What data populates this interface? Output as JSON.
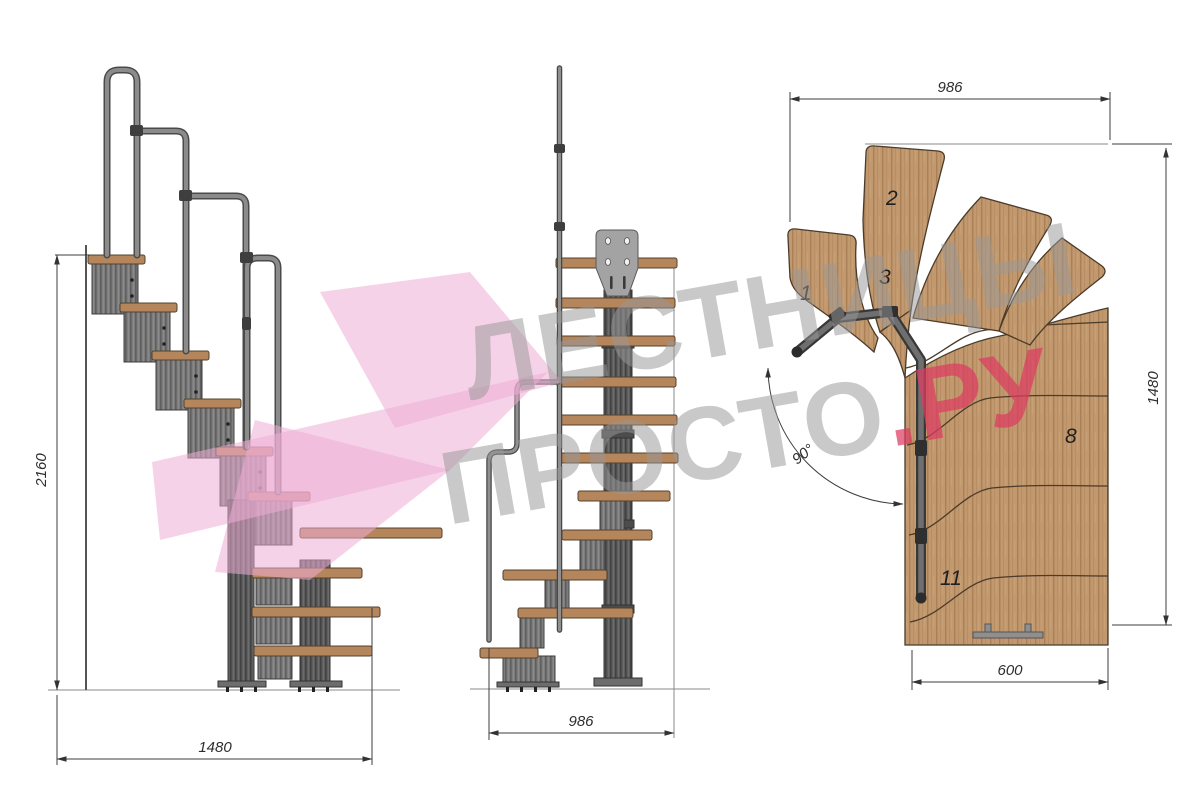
{
  "watermark": {
    "line1": "ЛЕСТНИЦЫ",
    "line2_grey": "ПРОСТО",
    "line2_pink": ".РУ"
  },
  "views": {
    "side": {
      "height_label": "2160",
      "width_label": "1480"
    },
    "front": {
      "width_label": "986"
    },
    "plan": {
      "top_width_label": "986",
      "height_label": "1480",
      "bottom_width_label": "600",
      "angle_label": "90°",
      "step_numbers": [
        "1",
        "2",
        "3",
        "8",
        "11"
      ]
    }
  },
  "colors": {
    "wood": "#c2986e",
    "wood_edge": "#4a3b2a",
    "metal": "#787878",
    "metal_dark": "#4a4a4a",
    "dimension": "#3c3c3c",
    "watermark_grey": "#989898",
    "watermark_pink": "#dc3b62",
    "watermark_arrow_pink": "#eeadd6"
  }
}
